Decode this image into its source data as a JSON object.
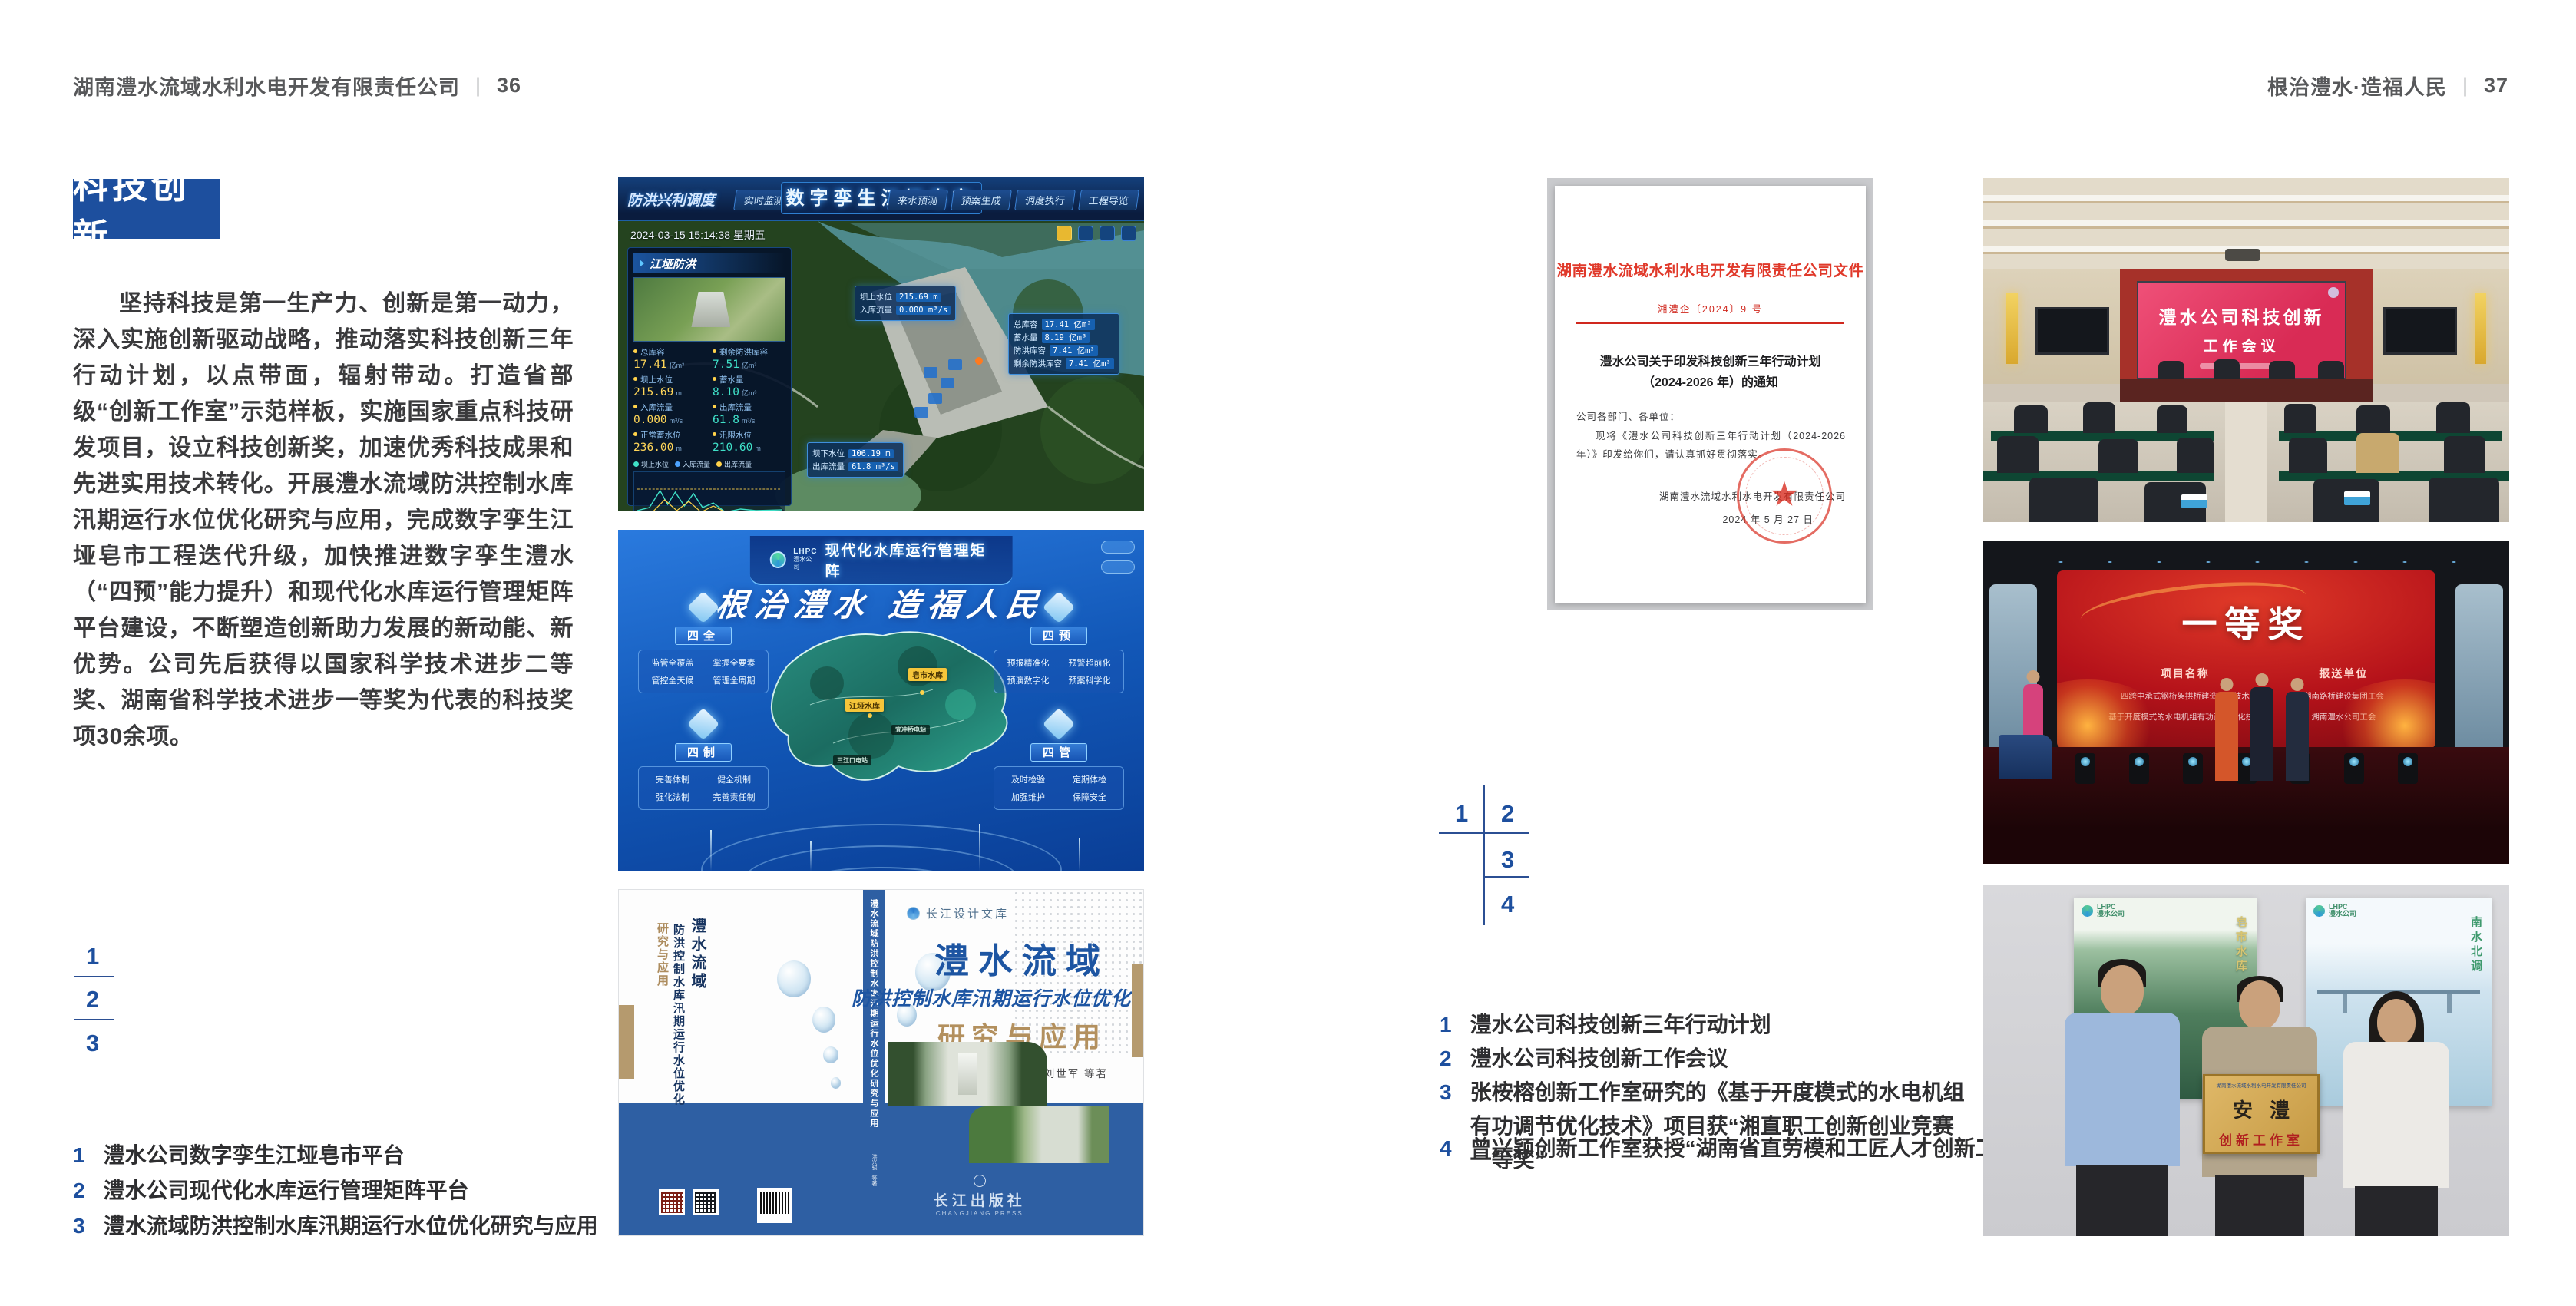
{
  "headers": {
    "left": {
      "company": "湖南澧水流域水利水电开发有限责任公司",
      "separator": "|",
      "page_no": "36"
    },
    "right": {
      "slogan": "根治澧水·造福人民",
      "separator": "|",
      "page_no": "37"
    }
  },
  "left_page": {
    "section_title": "科技创新",
    "body_paragraph": "坚持科技是第一生产力、创新是第一动力，深入实施创新驱动战略，推动落实科技创新三年行动计划，以点带面，辐射带动。打造省部级“创新工作室”示范样板，实施国家重点科技研发项目，设立科技创新奖，加速优秀科技成果和先进实用技术转化。开展澧水流域防洪控制水库汛期运行水位优化研究与应用，完成数字孪生江垭皂市工程迭代升级，加快推进数字孪生澧水（“四预”能力提升）和现代化水库运行管理矩阵平台建设，不断塑造创新助力发展的新动能、新优势。公司先后获得以国家科学技术进步二等奖、湖南省科学技术进步一等奖为代表的科技奖项30余项。",
    "figure_markers": [
      "1",
      "2",
      "3"
    ],
    "captions": [
      {
        "num": "1",
        "text": "澧水公司数字孪生江垭皂市平台"
      },
      {
        "num": "2",
        "text": "澧水公司现代化水库运行管理矩阵平台"
      },
      {
        "num": "3",
        "text": "澧水流域防洪控制水库汛期运行水位优化研究与应用"
      }
    ]
  },
  "right_page": {
    "figure_markers": [
      "1",
      "2",
      "3",
      "4"
    ],
    "captions": [
      {
        "num": "1",
        "text": "澧水公司科技创新三年行动计划"
      },
      {
        "num": "2",
        "text": "澧水公司科技创新工作会议"
      },
      {
        "num": "3",
        "text": "张桉榕创新工作室研究的《基于开度模式的水电机组有功调节优化技术》项目获“湘直职工创新创业竞赛一等奖”"
      },
      {
        "num": "4",
        "text": "曾兴颖创新工作室获授“湖南省直劳模和工匠人才创新工作室”"
      }
    ]
  },
  "dashboard": {
    "title": "数字孪生江垭皂市",
    "menu_label": "防洪兴利调度",
    "tabs_left": [
      "实时监测",
      "洪水预报",
      "防洪预警"
    ],
    "tabs_right": [
      "来水预测",
      "预案生成",
      "调度执行",
      "工程导览"
    ],
    "datetime": "2024-03-15 15:14:38 星期五",
    "panel1_title": "江垭防洪",
    "panel2_title": "江垭发电",
    "flood_stats": [
      {
        "label": "总库容",
        "value": "17.41",
        "unit": "亿m³"
      },
      {
        "label": "剩余防洪库容",
        "value": "7.51",
        "unit": "亿m³"
      },
      {
        "label": "坝上水位",
        "value": "215.69",
        "unit": "m"
      },
      {
        "label": "蓄水量",
        "value": "8.10",
        "unit": "亿m³"
      },
      {
        "label": "入库流量",
        "value": "0.000",
        "unit": "m³/s"
      },
      {
        "label": "出库流量",
        "value": "61.8",
        "unit": "m³/s"
      },
      {
        "label": "正常蓄水位",
        "value": "236.00",
        "unit": "m"
      },
      {
        "label": "汛限水位",
        "value": "210.60",
        "unit": "m"
      }
    ],
    "legend": [
      "坝上水位",
      "入库流量",
      "出库流量"
    ],
    "chart_x_labels": "03-12  03-13  03-13  03-14  03-14  03-15",
    "power_stats": [
      {
        "label": "年发电计划",
        "value": "6.3000",
        "unit": "亿度"
      },
      {
        "label": "年累计发电量",
        "value": "1.2907",
        "unit": "亿度"
      },
      {
        "label": "月累计发电量",
        "value": "3359.21",
        "unit": "万度"
      },
      {
        "label": "当前出力",
        "value": "0.00",
        "unit": "(MW)"
      },
      {
        "label": "发电流量",
        "value": "0.00",
        "unit": "m³/s"
      },
      {
        "label": "弃水流量",
        "value": "0.00",
        "unit": "m³/s"
      }
    ],
    "gauges": [
      {
        "value": "0.00"
      },
      {
        "value": "100.98"
      },
      {
        "value": "0.00"
      }
    ],
    "tooltip1": [
      {
        "label": "坝上水位",
        "value": "215.69 m"
      },
      {
        "label": "入库流量",
        "value": "0.000 m³/s"
      }
    ],
    "tooltip2": [
      {
        "label": "总库容",
        "value": "17.41 亿m³"
      },
      {
        "label": "蓄水量",
        "value": "8.19 亿m³"
      },
      {
        "label": "防洪库容",
        "value": "7.41 亿m³"
      },
      {
        "label": "剩余防洪库容",
        "value": "7.41 亿m³"
      }
    ],
    "tooltip3": [
      {
        "label": "坝下水位",
        "value": "106.19 m"
      },
      {
        "label": "出库流量",
        "value": "61.8 m³/s"
      }
    ]
  },
  "matrix": {
    "logo_abbr": "LHPC",
    "logo_name": "澧水公司",
    "title": "现代化水库运行管理矩阵",
    "slogan": "根治澧水  造福人民",
    "groups": [
      {
        "key": "四全",
        "items": [
          "监管全覆盖",
          "掌握全要素",
          "管控全天候",
          "管理全周期"
        ]
      },
      {
        "key": "四预",
        "items": [
          "预报精准化",
          "预警超前化",
          "预演数字化",
          "预案科学化"
        ]
      },
      {
        "key": "四制",
        "items": [
          "完善体制",
          "健全机制",
          "强化法制",
          "完善责任制"
        ]
      },
      {
        "key": "四管",
        "items": [
          "及时检验",
          "定期体检",
          "加强维护",
          "保障安全"
        ]
      }
    ],
    "map_labels": [
      {
        "text": "皂市水库"
      },
      {
        "text": "江垭水库"
      },
      {
        "text": "宜冲桥电站"
      },
      {
        "text": "三江口电站"
      }
    ]
  },
  "book": {
    "series": "长江设计文库",
    "title": "澧水流域",
    "subtitle": "防洪控制水库汛期运行水位优化",
    "title2": "研究与应用",
    "authors": "洪兴骏  沈坤民  鲁军  刘世军  等著",
    "spine_text": "澧水流域防洪控制水库汛期运行水位优化研究与应用",
    "spine_authors": "洪兴骏 等著",
    "back_title_1": "澧水流域",
    "back_title_2": "防洪控制水库汛期运行水位优化",
    "back_title_3": "研究与应用",
    "publisher": "长江出版社",
    "publisher_en": "CHANGJIANG PRESS"
  },
  "document": {
    "header": "湖南澧水流域水利水电开发有限责任公司文件",
    "doc_no": "湘澧企〔2024〕9 号",
    "title_line1": "澧水公司关于印发科技创新三年行动计划",
    "title_line2": "（2024-2026 年）的通知",
    "salutation": "公司各部门、各单位：",
    "body": "现将《澧水公司科技创新三年行动计划（2024-2026 年）》印发给你们，请认真抓好贯彻落实。",
    "signer": "湖南澧水流域水利水电开发有限责任公司",
    "date": "2024 年 5 月 27 日",
    "seal_star": "★"
  },
  "meeting_photo": {
    "screen_line1": "澧水公司科技创新",
    "screen_line2": "工作会议"
  },
  "award_photo": {
    "prize": "一等奖",
    "col1_header": "项目名称",
    "col2_header": "报送单位",
    "col1_rows": [
      "四跨中承式钢桁架拱桥建造创新技术",
      "基于开度模式的水电机组有功调节优化技术"
    ],
    "col2_rows": [
      "湖南路桥建设集团工会",
      "湖南澧水公司工会"
    ]
  },
  "plaque_photo": {
    "poster_left_logo": "LHPC",
    "poster_left_logo_sub": "澧水公司",
    "poster_left_caption": "皂市水库",
    "poster_right_logo": "LHPC",
    "poster_right_logo_sub": "澧水公司",
    "poster_right_caption": "南水北调",
    "plaque_org": "湖南澧水流域水利水电开发有限责任公司",
    "plaque_main": "安澧",
    "plaque_sub": "创新工作室"
  }
}
